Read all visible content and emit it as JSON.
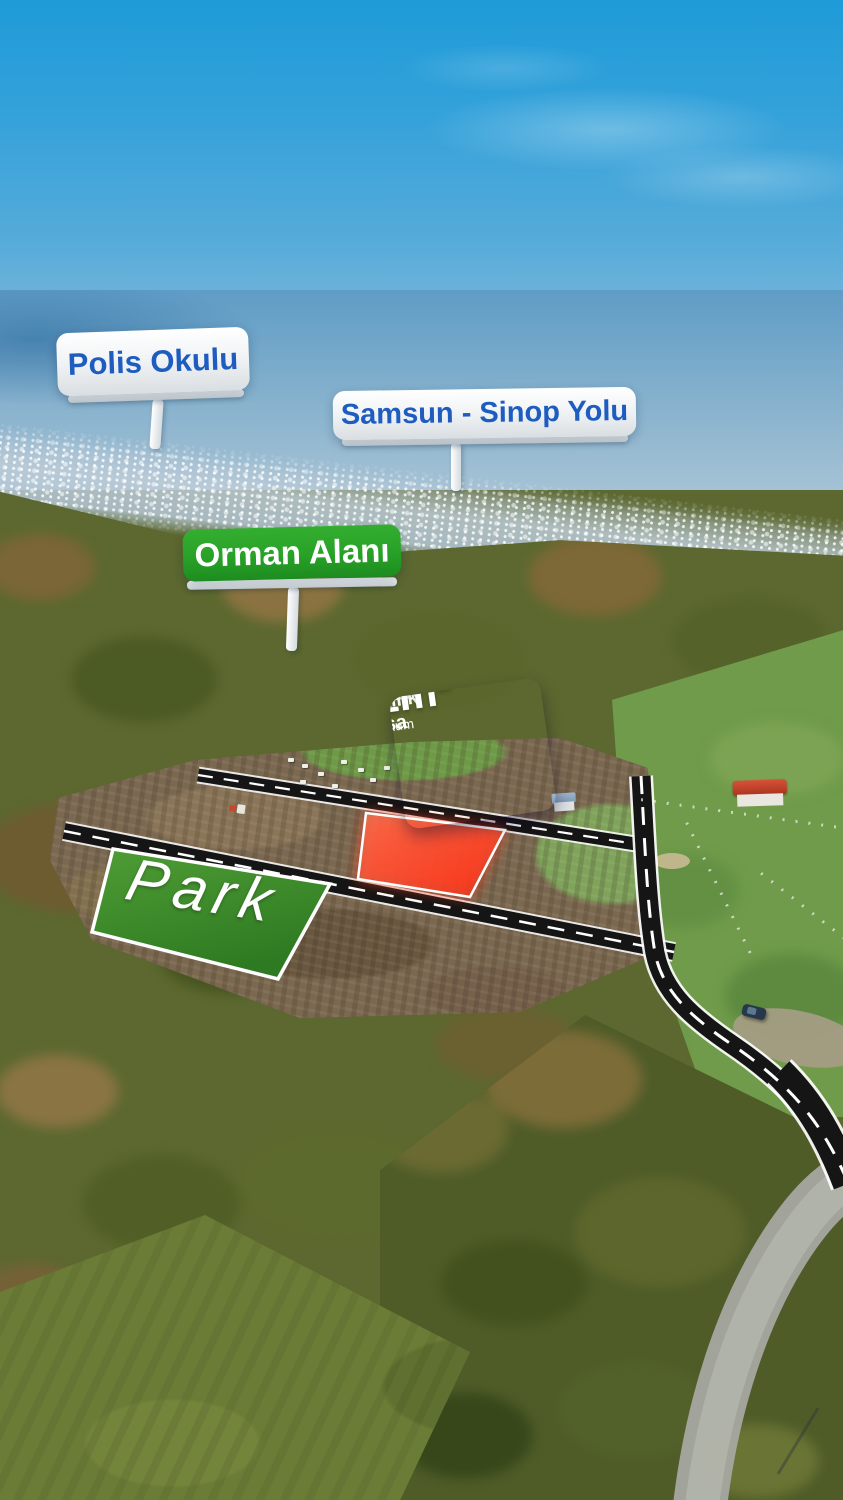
{
  "location_signs": {
    "polis_okulu": {
      "label": "Polis Okulu"
    },
    "samsun_sinop_yolu": {
      "label": "Samsun - Sinop Yolu"
    },
    "orman_alani": {
      "label": "Orman Alanı"
    }
  },
  "listing_sign": {
    "region": "Samsun / Atakum",
    "title": "Satılık Arsa",
    "area": "831m²"
  },
  "park": {
    "label": "Park"
  },
  "colors": {
    "sign_text_blue": "#1e5cc0",
    "forest_sign_green": "#28a128",
    "listing_navy": "#1f2a6d",
    "listing_red_stripe": "#cf2145",
    "listing_blue": "#1b58c9",
    "listing_purple_light": "#a83f9c",
    "listing_purple_dark": "#39206f",
    "highlight_parcel_red": "#ff3a1e",
    "park_green": "#3e8d2c",
    "sky_blue": "#2aa2dd"
  }
}
